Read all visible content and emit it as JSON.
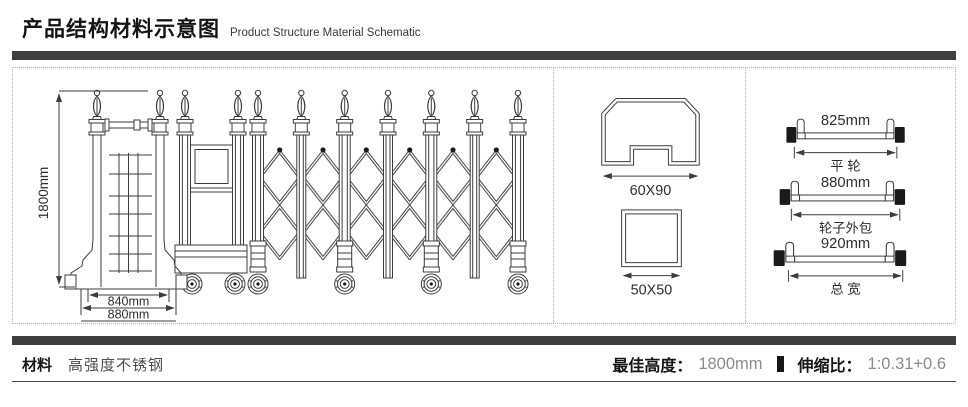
{
  "header": {
    "title_zh": "产品结构材料示意图",
    "title_en": "Product Structure Material Schematic"
  },
  "gate": {
    "height_label": "1800mm",
    "inner_width_label": "840mm",
    "outer_width_label": "880mm"
  },
  "profiles": {
    "rail_section_label": "60X90",
    "post_section_label": "50X50"
  },
  "axles": [
    {
      "value": "825mm",
      "label": "平 轮"
    },
    {
      "value": "880mm",
      "label": "轮子外包"
    },
    {
      "value": "920mm",
      "label": "总 宽"
    }
  ],
  "footer": {
    "material_label": "材料",
    "material_value": "高强度不锈钢",
    "best_height_label": "最佳高度：",
    "best_height_value": "1800mm",
    "ratio_label": "伸缩比：",
    "ratio_value": "1:0.31+0.6"
  },
  "colors": {
    "accent_bar": "#3f3f3f",
    "line": "#3d3d3d"
  }
}
